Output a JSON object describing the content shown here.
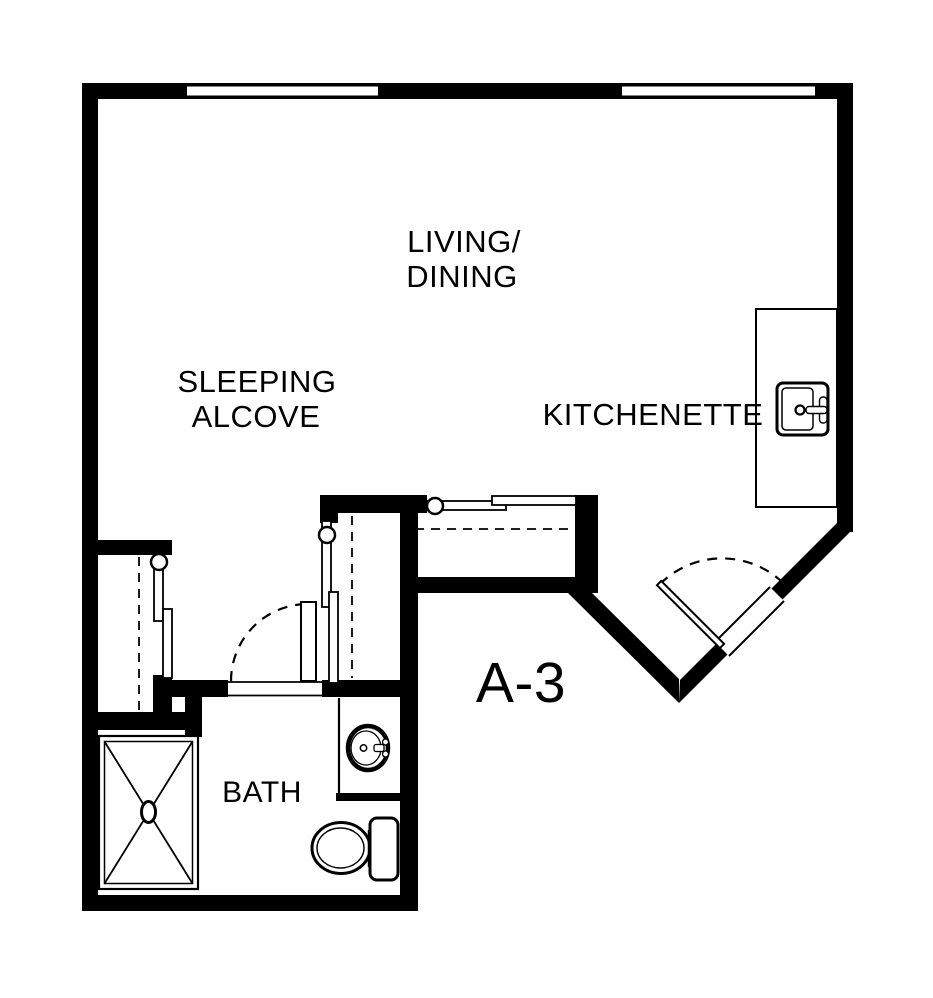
{
  "plan": {
    "unit_label": "A-3",
    "rooms": {
      "living_dining": {
        "line1": "LIVING/",
        "line2": "DINING"
      },
      "sleeping_alcove": {
        "line1": "SLEEPING",
        "line2": "ALCOVE"
      },
      "kitchenette": {
        "label": "KITCHENETTE"
      },
      "bath": {
        "label": "BATH"
      }
    },
    "fixtures": [
      "shower",
      "toilet",
      "bathroom-sink",
      "kitchen-sink",
      "kitchen-counter"
    ],
    "doors": [
      "entry-door",
      "bath-door",
      "sliding-closet-door-left",
      "sliding-closet-door-right",
      "sliding-closet-door-hall"
    ],
    "windows": [
      "window-left",
      "window-right"
    ],
    "colors": {
      "wall": "#000000",
      "background": "#ffffff"
    }
  }
}
